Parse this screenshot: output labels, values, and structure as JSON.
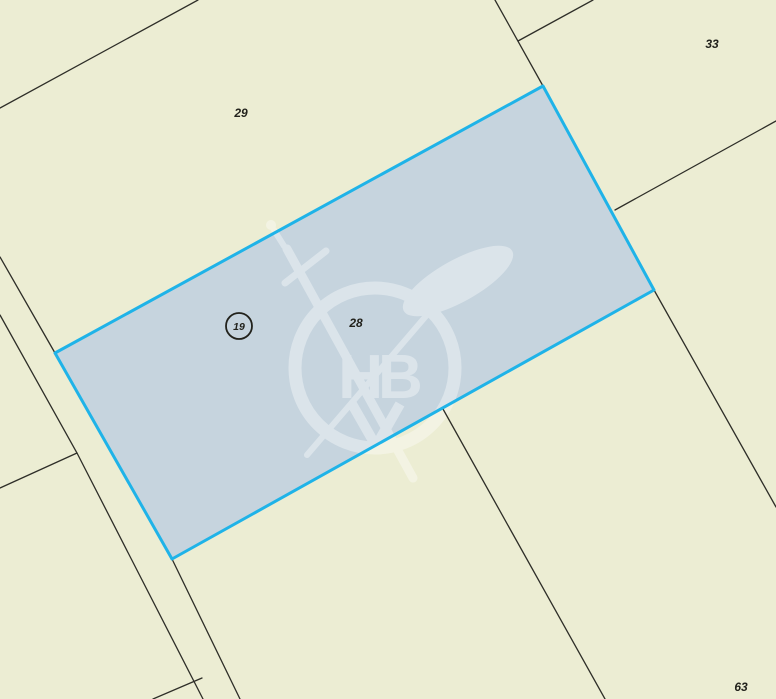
{
  "map": {
    "type": "cadastral-parcel-map",
    "selected_parcel": {
      "id": "28"
    },
    "parcel_labels": [
      {
        "label": "29",
        "x": 241,
        "y": 117
      },
      {
        "label": "33",
        "x": 712,
        "y": 48
      },
      {
        "label": "28",
        "x": 356,
        "y": 327
      },
      {
        "label": "63",
        "x": 741,
        "y": 691
      }
    ],
    "point_marker": {
      "label": "19",
      "cx": 239,
      "cy": 326,
      "r": 13
    },
    "watermark": {
      "monogram": "HB"
    },
    "colors": {
      "background": "#ecedd3",
      "selected_fill": "#c6d4de",
      "selected_border": "#1fb3e8",
      "boundary_line": "#2e2e28",
      "label_text": "#22221c",
      "watermark_tint": "#ffffff"
    }
  }
}
